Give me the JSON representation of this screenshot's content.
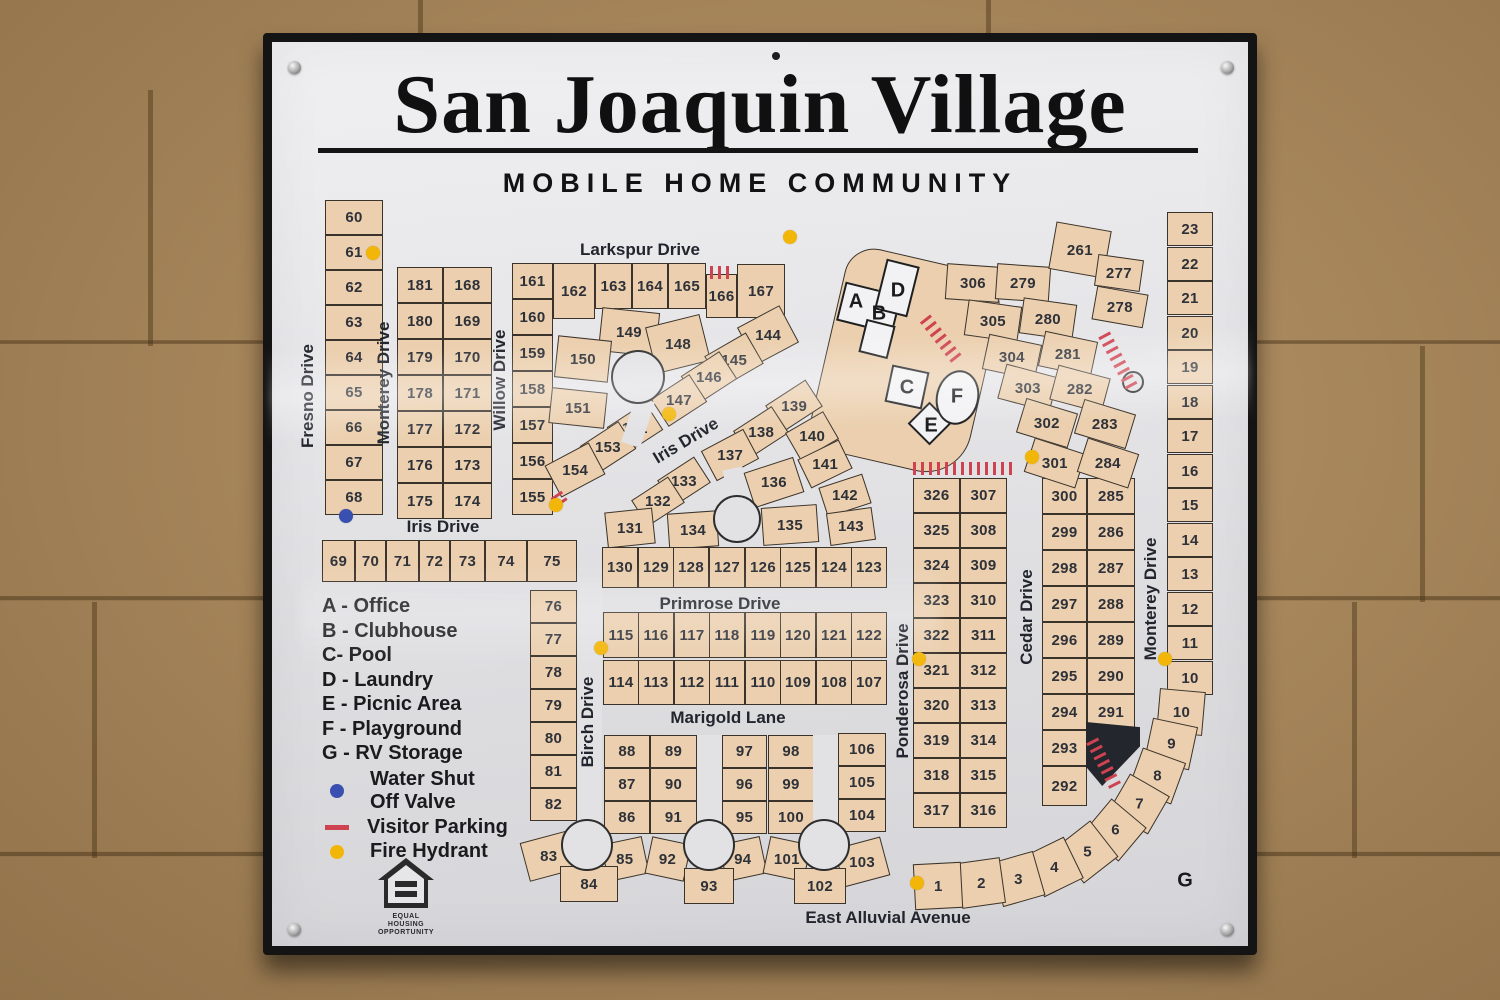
{
  "sign": {
    "title": "San Joaquin Village",
    "subtitle": "MOBILE HOME COMMUNITY"
  },
  "legend": {
    "facilities": [
      "A - Office",
      "B - Clubhouse",
      "C- Pool",
      "D - Laundry",
      "E - Picnic Area",
      "F - Playground",
      "G - RV Storage"
    ],
    "symbols": [
      {
        "id": "water-valve",
        "shape": "dot",
        "color": "#3a50b0",
        "line1": "Water Shut",
        "line2": "Off Valve"
      },
      {
        "id": "visitor-parking",
        "shape": "dash",
        "color": "#cf4250",
        "line1": "Visitor Parking"
      },
      {
        "id": "fire-hydrant",
        "shape": "dot",
        "color": "#f2b608",
        "line1": "Fire Hydrant"
      }
    ],
    "equal_housing": [
      "EQUAL HOUSING",
      "OPPORTUNITY"
    ]
  },
  "colors": {
    "lot": "#ebcfae",
    "lotBorder": "#3a332c",
    "road": "#e2e2e5",
    "hydrant": "#f2b608",
    "valve": "#3a50b0",
    "parking": "#cf4250"
  },
  "streets": [
    {
      "label": "Larkspur Drive",
      "x": 640,
      "y": 250,
      "r": 0
    },
    {
      "label": "Fresno Drive",
      "x": 308,
      "y": 396,
      "r": -90
    },
    {
      "label": "Monterey Drive",
      "x": 384,
      "y": 383,
      "r": -90
    },
    {
      "label": "Willow Drive",
      "x": 500,
      "y": 380,
      "r": -90
    },
    {
      "label": "Iris Drive",
      "x": 443,
      "y": 527,
      "r": 0
    },
    {
      "label": "Iris Drive",
      "x": 686,
      "y": 441,
      "r": -31
    },
    {
      "label": "Primrose Drive",
      "x": 720,
      "y": 604,
      "r": 0
    },
    {
      "label": "Marigold Lane",
      "x": 728,
      "y": 718,
      "r": 0
    },
    {
      "label": "Birch Drive",
      "x": 588,
      "y": 722,
      "r": -90
    },
    {
      "label": "Ponderosa Drive",
      "x": 903,
      "y": 691,
      "r": -90
    },
    {
      "label": "Cedar Drive",
      "x": 1027,
      "y": 617,
      "r": -90
    },
    {
      "label": "Monterey Drive",
      "x": 1151,
      "y": 599,
      "r": -90
    },
    {
      "label": "East Alluvial Avenue",
      "x": 888,
      "y": 918,
      "r": 0
    }
  ],
  "facility_labels": [
    {
      "key": "A",
      "x": 856,
      "y": 302
    },
    {
      "key": "B",
      "x": 879,
      "y": 314
    },
    {
      "key": "C",
      "x": 907,
      "y": 388
    },
    {
      "key": "D",
      "x": 898,
      "y": 291
    },
    {
      "key": "E",
      "x": 931,
      "y": 426
    },
    {
      "key": "F",
      "x": 957,
      "y": 397
    },
    {
      "key": "G",
      "x": 1185,
      "y": 881
    }
  ],
  "lots": [
    [
      "60",
      325,
      200,
      58,
      35
    ],
    [
      "61",
      325,
      235,
      58,
      35
    ],
    [
      "62",
      325,
      270,
      58,
      35
    ],
    [
      "63",
      325,
      305,
      58,
      35
    ],
    [
      "64",
      325,
      340,
      58,
      35
    ],
    [
      "65",
      325,
      375,
      58,
      35
    ],
    [
      "66",
      325,
      410,
      58,
      35
    ],
    [
      "67",
      325,
      445,
      58,
      35
    ],
    [
      "68",
      325,
      480,
      58,
      35
    ],
    [
      "181",
      397,
      267,
      46,
      36
    ],
    [
      "180",
      397,
      303,
      46,
      36
    ],
    [
      "179",
      397,
      339,
      46,
      36
    ],
    [
      "178",
      397,
      375,
      46,
      36
    ],
    [
      "177",
      397,
      411,
      46,
      36
    ],
    [
      "176",
      397,
      447,
      46,
      36
    ],
    [
      "175",
      397,
      483,
      46,
      36
    ],
    [
      "168",
      443,
      267,
      49,
      36
    ],
    [
      "169",
      443,
      303,
      49,
      36
    ],
    [
      "170",
      443,
      339,
      49,
      36
    ],
    [
      "171",
      443,
      375,
      49,
      36
    ],
    [
      "172",
      443,
      411,
      49,
      36
    ],
    [
      "173",
      443,
      447,
      49,
      36
    ],
    [
      "174",
      443,
      483,
      49,
      36
    ],
    [
      "161",
      512,
      263,
      41,
      36
    ],
    [
      "160",
      512,
      299,
      41,
      36
    ],
    [
      "159",
      512,
      335,
      41,
      36
    ],
    [
      "158",
      512,
      371,
      41,
      36
    ],
    [
      "157",
      512,
      407,
      41,
      36
    ],
    [
      "156",
      512,
      443,
      41,
      36
    ],
    [
      "155",
      512,
      479,
      41,
      36
    ],
    [
      "162",
      553,
      263,
      42,
      56
    ],
    [
      "163",
      595,
      263,
      37,
      46
    ],
    [
      "164",
      632,
      263,
      36,
      46
    ],
    [
      "165",
      668,
      263,
      38,
      46
    ],
    [
      "166",
      706,
      274,
      31,
      44
    ],
    [
      "167",
      737,
      264,
      48,
      54
    ],
    [
      "149",
      600,
      310,
      58,
      44,
      6
    ],
    [
      "150",
      556,
      338,
      54,
      42,
      6
    ],
    [
      "148",
      650,
      320,
      56,
      48,
      -14
    ],
    [
      "144",
      744,
      314,
      48,
      42,
      -28
    ],
    [
      "145",
      710,
      342,
      48,
      36,
      -30
    ],
    [
      "146",
      686,
      361,
      46,
      33,
      -33
    ],
    [
      "147",
      656,
      384,
      46,
      33,
      -33
    ],
    [
      "151",
      550,
      390,
      56,
      36,
      6
    ],
    [
      "152",
      612,
      412,
      46,
      33,
      -33
    ],
    [
      "153",
      585,
      431,
      46,
      33,
      -33
    ],
    [
      "154",
      550,
      452,
      50,
      36,
      -28
    ],
    [
      "139",
      770,
      390,
      48,
      32,
      -33
    ],
    [
      "138",
      738,
      416,
      46,
      32,
      -33
    ],
    [
      "140",
      790,
      420,
      44,
      32,
      -30
    ],
    [
      "141",
      802,
      448,
      46,
      32,
      -26
    ],
    [
      "137",
      706,
      438,
      48,
      34,
      -28
    ],
    [
      "136",
      748,
      464,
      52,
      37,
      -18
    ],
    [
      "142",
      822,
      480,
      46,
      31,
      -18
    ],
    [
      "135",
      762,
      506,
      56,
      38,
      -4
    ],
    [
      "143",
      828,
      510,
      46,
      33,
      -8
    ],
    [
      "133",
      662,
      466,
      44,
      31,
      -33
    ],
    [
      "132",
      636,
      486,
      44,
      31,
      -33
    ],
    [
      "131",
      606,
      510,
      48,
      36,
      -6
    ],
    [
      "134",
      668,
      512,
      50,
      36,
      -4
    ],
    [
      "130",
      602,
      547,
      36,
      41
    ],
    [
      "129",
      638,
      547,
      36,
      41
    ],
    [
      "128",
      673,
      547,
      36,
      41
    ],
    [
      "127",
      709,
      547,
      36,
      41
    ],
    [
      "126",
      745,
      547,
      36,
      41
    ],
    [
      "125",
      780,
      547,
      36,
      41
    ],
    [
      "124",
      816,
      547,
      36,
      41
    ],
    [
      "123",
      851,
      547,
      36,
      41
    ],
    [
      "69",
      322,
      540,
      33,
      42
    ],
    [
      "70",
      355,
      540,
      31,
      42
    ],
    [
      "71",
      386,
      540,
      33,
      42
    ],
    [
      "72",
      419,
      540,
      31,
      42
    ],
    [
      "73",
      450,
      540,
      35,
      42
    ],
    [
      "74",
      485,
      540,
      42,
      42
    ],
    [
      "75",
      527,
      540,
      50,
      42
    ],
    [
      "76",
      530,
      590,
      47,
      33
    ],
    [
      "77",
      530,
      623,
      47,
      33
    ],
    [
      "78",
      530,
      656,
      47,
      33
    ],
    [
      "79",
      530,
      689,
      47,
      33
    ],
    [
      "80",
      530,
      722,
      47,
      33
    ],
    [
      "81",
      530,
      755,
      47,
      33
    ],
    [
      "82",
      530,
      788,
      47,
      33
    ],
    [
      "115",
      603,
      612,
      36,
      46
    ],
    [
      "116",
      638,
      612,
      36,
      46
    ],
    [
      "117",
      674,
      612,
      36,
      46
    ],
    [
      "118",
      709,
      612,
      36,
      46
    ],
    [
      "119",
      745,
      612,
      36,
      46
    ],
    [
      "120",
      780,
      612,
      36,
      46
    ],
    [
      "121",
      816,
      612,
      36,
      46
    ],
    [
      "122",
      851,
      612,
      36,
      46
    ],
    [
      "114",
      603,
      660,
      36,
      45
    ],
    [
      "113",
      638,
      660,
      36,
      45
    ],
    [
      "112",
      674,
      660,
      36,
      45
    ],
    [
      "111",
      709,
      660,
      36,
      45
    ],
    [
      "110",
      745,
      660,
      36,
      45
    ],
    [
      "109",
      780,
      660,
      36,
      45
    ],
    [
      "108",
      816,
      660,
      36,
      45
    ],
    [
      "107",
      851,
      660,
      36,
      45
    ],
    [
      "88",
      604,
      735,
      46,
      33
    ],
    [
      "89",
      650,
      735,
      47,
      33
    ],
    [
      "87",
      604,
      768,
      46,
      33
    ],
    [
      "90",
      650,
      768,
      47,
      33
    ],
    [
      "86",
      604,
      801,
      46,
      33
    ],
    [
      "91",
      650,
      801,
      47,
      33
    ],
    [
      "85",
      604,
      840,
      42,
      38,
      -12
    ],
    [
      "92",
      648,
      840,
      40,
      38,
      12
    ],
    [
      "83",
      524,
      836,
      50,
      40,
      -15
    ],
    [
      "84",
      560,
      866,
      58,
      36
    ],
    [
      "97",
      722,
      735,
      45,
      33
    ],
    [
      "98",
      768,
      735,
      46,
      33
    ],
    [
      "96",
      722,
      768,
      45,
      33
    ],
    [
      "99",
      768,
      768,
      46,
      33
    ],
    [
      "95",
      722,
      801,
      45,
      33
    ],
    [
      "100",
      768,
      801,
      46,
      33
    ],
    [
      "94",
      722,
      840,
      42,
      38,
      -12
    ],
    [
      "101",
      766,
      840,
      42,
      38,
      12
    ],
    [
      "93",
      684,
      868,
      50,
      36
    ],
    [
      "106",
      838,
      733,
      48,
      33
    ],
    [
      "105",
      838,
      766,
      48,
      33
    ],
    [
      "104",
      838,
      799,
      48,
      33
    ],
    [
      "103",
      838,
      842,
      48,
      40,
      -15
    ],
    [
      "102",
      794,
      868,
      52,
      36
    ],
    [
      "326",
      913,
      478,
      47,
      35
    ],
    [
      "325",
      913,
      513,
      47,
      35
    ],
    [
      "324",
      913,
      548,
      47,
      35
    ],
    [
      "323",
      913,
      583,
      47,
      35
    ],
    [
      "322",
      913,
      618,
      47,
      35
    ],
    [
      "321",
      913,
      653,
      47,
      35
    ],
    [
      "320",
      913,
      688,
      47,
      35
    ],
    [
      "319",
      913,
      723,
      47,
      35
    ],
    [
      "318",
      913,
      758,
      47,
      35
    ],
    [
      "317",
      913,
      793,
      47,
      35
    ],
    [
      "307",
      960,
      478,
      47,
      35
    ],
    [
      "308",
      960,
      513,
      47,
      35
    ],
    [
      "309",
      960,
      548,
      47,
      35
    ],
    [
      "310",
      960,
      583,
      47,
      35
    ],
    [
      "311",
      960,
      618,
      47,
      35
    ],
    [
      "312",
      960,
      653,
      47,
      35
    ],
    [
      "313",
      960,
      688,
      47,
      35
    ],
    [
      "314",
      960,
      723,
      47,
      35
    ],
    [
      "315",
      960,
      758,
      47,
      35
    ],
    [
      "316",
      960,
      793,
      47,
      35
    ],
    [
      "300",
      1042,
      478,
      45,
      36
    ],
    [
      "299",
      1042,
      514,
      45,
      36
    ],
    [
      "298",
      1042,
      550,
      45,
      36
    ],
    [
      "297",
      1042,
      586,
      45,
      36
    ],
    [
      "296",
      1042,
      622,
      45,
      36
    ],
    [
      "295",
      1042,
      658,
      45,
      36
    ],
    [
      "294",
      1042,
      694,
      45,
      36
    ],
    [
      "293",
      1042,
      730,
      45,
      36
    ],
    [
      "292",
      1042,
      766,
      45,
      40
    ],
    [
      "285",
      1087,
      478,
      48,
      36
    ],
    [
      "286",
      1087,
      514,
      48,
      36
    ],
    [
      "287",
      1087,
      550,
      48,
      36
    ],
    [
      "288",
      1087,
      586,
      48,
      36
    ],
    [
      "289",
      1087,
      622,
      48,
      36
    ],
    [
      "290",
      1087,
      658,
      48,
      36
    ],
    [
      "291",
      1087,
      694,
      48,
      36
    ],
    [
      "306",
      946,
      265,
      54,
      36,
      4
    ],
    [
      "279",
      996,
      265,
      54,
      36,
      4
    ],
    [
      "305",
      966,
      303,
      54,
      36,
      8
    ],
    [
      "280",
      1021,
      301,
      54,
      36,
      8
    ],
    [
      "304",
      985,
      339,
      54,
      36,
      12
    ],
    [
      "281",
      1041,
      336,
      54,
      36,
      12
    ],
    [
      "303",
      1001,
      370,
      54,
      36,
      15
    ],
    [
      "282",
      1053,
      371,
      54,
      36,
      15
    ],
    [
      "302",
      1020,
      405,
      54,
      36,
      17
    ],
    [
      "283",
      1078,
      406,
      54,
      36,
      17
    ],
    [
      "301",
      1028,
      445,
      54,
      36,
      18
    ],
    [
      "284",
      1081,
      445,
      54,
      36,
      18
    ],
    [
      "261",
      1052,
      226,
      56,
      48,
      10
    ],
    [
      "277",
      1096,
      257,
      46,
      32,
      8
    ],
    [
      "278",
      1094,
      290,
      52,
      34,
      10
    ],
    [
      "23",
      1167,
      212,
      46,
      34
    ],
    [
      "22",
      1167,
      247,
      46,
      34
    ],
    [
      "21",
      1167,
      281,
      46,
      34
    ],
    [
      "20",
      1167,
      316,
      46,
      34
    ],
    [
      "19",
      1167,
      350,
      46,
      34
    ],
    [
      "18",
      1167,
      385,
      46,
      34
    ],
    [
      "17",
      1167,
      419,
      46,
      34
    ],
    [
      "16",
      1167,
      454,
      46,
      34
    ],
    [
      "15",
      1167,
      488,
      46,
      34
    ],
    [
      "14",
      1167,
      523,
      46,
      34
    ],
    [
      "13",
      1167,
      557,
      46,
      34
    ],
    [
      "12",
      1167,
      592,
      46,
      34
    ],
    [
      "11",
      1167,
      626,
      46,
      34
    ],
    [
      "10",
      1167,
      661,
      46,
      34
    ],
    [
      "10",
      1159,
      689,
      44,
      46,
      -85
    ],
    [
      "9",
      1149,
      721,
      44,
      46,
      -78
    ],
    [
      "8",
      1135,
      753,
      44,
      46,
      -70
    ],
    [
      "7",
      1117,
      781,
      44,
      46,
      -60
    ],
    [
      "6",
      1093,
      807,
      44,
      46,
      -50
    ],
    [
      "5",
      1065,
      829,
      44,
      46,
      -38
    ],
    [
      "4",
      1032,
      844,
      44,
      46,
      -26
    ],
    [
      "3",
      996,
      856,
      44,
      46,
      -16
    ],
    [
      "2",
      959,
      860,
      44,
      46,
      -8
    ],
    [
      "1",
      914,
      863,
      48,
      46,
      -3
    ]
  ],
  "hydrants": [
    [
      373,
      253
    ],
    [
      790,
      237
    ],
    [
      669,
      414
    ],
    [
      556,
      505
    ],
    [
      601,
      648
    ],
    [
      1032,
      457
    ],
    [
      919,
      659
    ],
    [
      1165,
      659
    ],
    [
      917,
      883
    ]
  ],
  "valves": [
    [
      346,
      516
    ]
  ],
  "map_shapes": {
    "culdesacs": [
      {
        "x": 638,
        "y": 377,
        "rad": 27
      },
      {
        "x": 737,
        "y": 519,
        "rad": 24
      },
      {
        "x": 587,
        "y": 845,
        "rad": 26
      },
      {
        "x": 709,
        "y": 845,
        "rad": 26
      },
      {
        "x": 824,
        "y": 845,
        "rad": 26
      },
      {
        "x": 1133,
        "y": 382,
        "rad": 11
      }
    ],
    "stems": [
      {
        "x": 628,
        "y": 398,
        "w": 20,
        "h": 48,
        "r": 18
      },
      {
        "x": 728,
        "y": 468,
        "w": 20,
        "h": 54,
        "r": -12
      },
      {
        "x": 578,
        "y": 582,
        "w": 24,
        "h": 240
      },
      {
        "x": 697,
        "y": 735,
        "w": 25,
        "h": 88
      },
      {
        "x": 813,
        "y": 735,
        "w": 25,
        "h": 88
      }
    ],
    "tick_groups": [
      {
        "x": 710,
        "y": 266,
        "n": 3,
        "r": 0
      },
      {
        "x": 925,
        "y": 312,
        "n": 7,
        "r": 52
      },
      {
        "x": 913,
        "y": 462,
        "n": 13,
        "r": 0
      },
      {
        "x": 1104,
        "y": 328,
        "n": 8,
        "r": 62
      },
      {
        "x": 1092,
        "y": 734,
        "n": 7,
        "r": 63
      },
      {
        "x": 556,
        "y": 488,
        "n": 2,
        "r": 55
      }
    ],
    "wedge": {
      "x": 1086,
      "y": 722,
      "w": 54,
      "h": 64
    }
  }
}
